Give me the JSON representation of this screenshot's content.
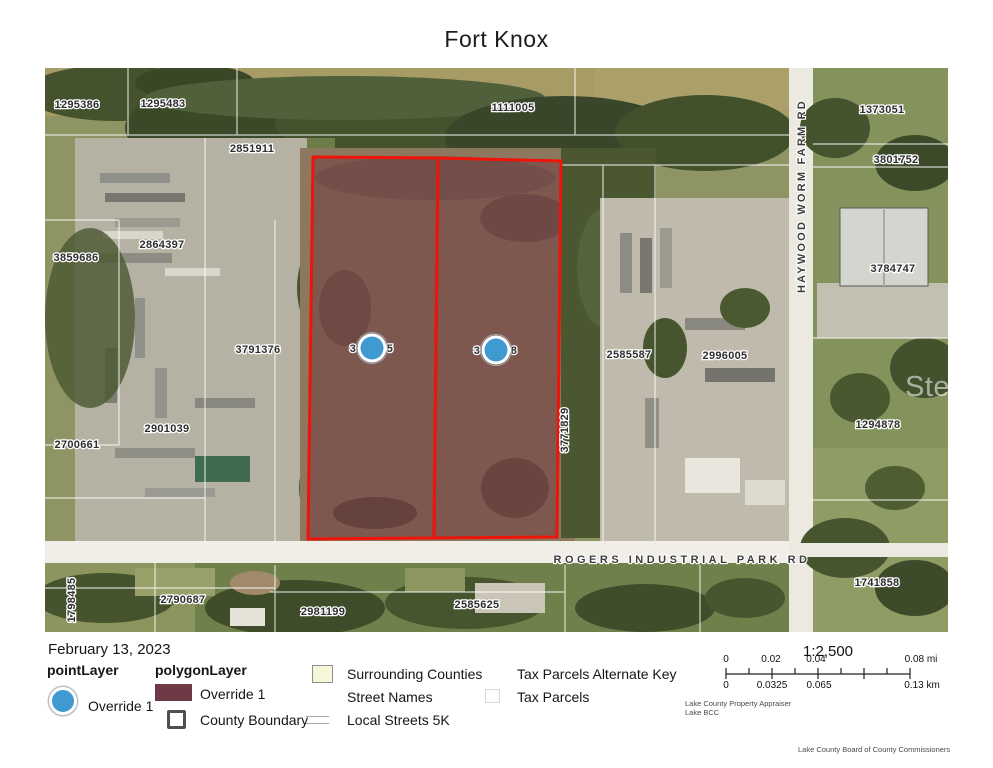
{
  "title": "Fort Knox",
  "watermark": "StellarMLS",
  "map": {
    "colors": {
      "selection_outline": "#ee1409",
      "selection_fill": "#70383f",
      "point": "#3f9ad2",
      "polygon_swatch": "#6e3a45",
      "surrounding_swatch": "#f6f6d9"
    },
    "selected_parcels": [
      "268,89 393,90 389,470 263,471",
      "393,90 516,93 512,469 389,470"
    ],
    "point_markers": [
      {
        "x": 327,
        "y": 280,
        "prefix": "3",
        "suffix": "5"
      },
      {
        "x": 451,
        "y": 282,
        "prefix": "3",
        "suffix": "8"
      }
    ],
    "parcel_labels": [
      {
        "t": "1295386",
        "x": 32,
        "y": 37
      },
      {
        "t": "1295483",
        "x": 118,
        "y": 36
      },
      {
        "t": "1111005",
        "x": 468,
        "y": 40
      },
      {
        "t": "1373051",
        "x": 837,
        "y": 42
      },
      {
        "t": "2851911",
        "x": 207,
        "y": 81
      },
      {
        "t": "3801752",
        "x": 851,
        "y": 92
      },
      {
        "t": "2864397",
        "x": 117,
        "y": 177
      },
      {
        "t": "3859686",
        "x": 31,
        "y": 190
      },
      {
        "t": "3784747",
        "x": 848,
        "y": 201
      },
      {
        "t": "3791376",
        "x": 213,
        "y": 282
      },
      {
        "t": "2585587",
        "x": 584,
        "y": 287
      },
      {
        "t": "2996005",
        "x": 680,
        "y": 288
      },
      {
        "t": "2901039",
        "x": 122,
        "y": 361
      },
      {
        "t": "2700661",
        "x": 32,
        "y": 377
      },
      {
        "t": "1294878",
        "x": 833,
        "y": 357
      },
      {
        "t": "3771829",
        "x": 520,
        "y": 362,
        "rot": -90
      },
      {
        "t": "1741858",
        "x": 832,
        "y": 515
      },
      {
        "t": "2790687",
        "x": 138,
        "y": 532
      },
      {
        "t": "2981199",
        "x": 278,
        "y": 544
      },
      {
        "t": "2585625",
        "x": 432,
        "y": 537
      },
      {
        "t": "1798485",
        "x": 27,
        "y": 532,
        "rot": -90
      }
    ],
    "road_labels": [
      {
        "t": "HAYWOOD WORM FARM RD",
        "x": 757,
        "y": 128,
        "rot": -90,
        "ls": 2.2
      },
      {
        "t": "ROGERS INDUSTRIAL PARK RD",
        "x": 637,
        "y": 492,
        "ls": 3.5
      }
    ]
  },
  "legend": {
    "date": "February 13, 2023",
    "point_layer": {
      "title": "pointLayer",
      "item": "Override 1"
    },
    "polygon_layer": {
      "title": "polygonLayer",
      "item1": "Override 1",
      "item2": "County Boundary"
    },
    "surrounding_counties": "Surrounding Counties",
    "street_names": "Street Names",
    "local_streets": "Local Streets 5K",
    "tax_parcels_alt_key": "Tax Parcels Alternate Key",
    "tax_parcels": "Tax Parcels"
  },
  "scalebar": {
    "ratio": "1:2,500",
    "mi_labels": [
      {
        "t": "0",
        "x": 726
      },
      {
        "t": "0.02",
        "x": 771
      },
      {
        "t": "0.04",
        "x": 816
      },
      {
        "t": "0.08 mi",
        "x": 921
      }
    ],
    "km_labels": [
      {
        "t": "0",
        "x": 726
      },
      {
        "t": "0.0325",
        "x": 772
      },
      {
        "t": "0.065",
        "x": 819
      },
      {
        "t": "0.13 km",
        "x": 922
      }
    ]
  },
  "attribution": {
    "line1": "Lake County Property Appraiser",
    "line2": "Lake BCC",
    "footer": "Lake County Board of County Commissioners"
  }
}
